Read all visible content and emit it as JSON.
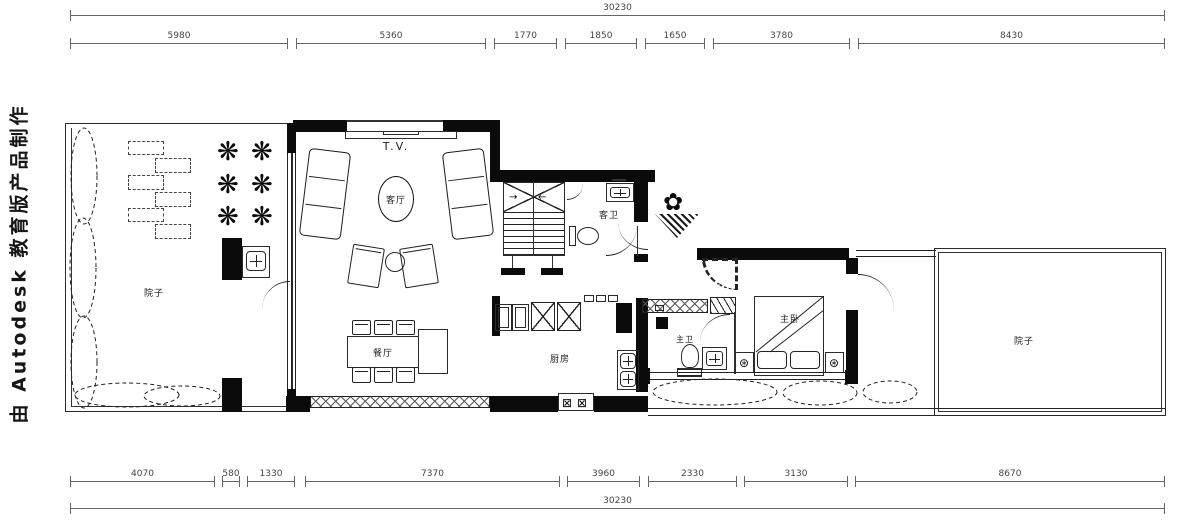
{
  "watermark": {
    "text": "由 Autodesk 教育版产品制作"
  },
  "icons": {
    "tree": "❋",
    "plant": "✿",
    "lamp": "⊛",
    "burner": "⊠",
    "arrow_left": "←",
    "arrow_right": "→"
  },
  "dims": {
    "top_total": "30230",
    "bottom_total": "30230",
    "top": [
      {
        "v": "5980"
      },
      {
        "v": "5360"
      },
      {
        "v": "1770"
      },
      {
        "v": "1850"
      },
      {
        "v": "1650"
      },
      {
        "v": "3780"
      },
      {
        "v": "8430"
      }
    ],
    "bottom": [
      {
        "v": "4070"
      },
      {
        "v": "580"
      },
      {
        "v": "1330"
      },
      {
        "v": "7370"
      },
      {
        "v": "3960"
      },
      {
        "v": "2330"
      },
      {
        "v": "3130"
      },
      {
        "v": "8670"
      }
    ]
  },
  "rooms": {
    "tv": "T.V.",
    "living": "客厅",
    "dining": "餐厅",
    "kitchen": "厨房",
    "guest_bath": "客卫",
    "master_bath": "主卫",
    "master_bed": "主卧",
    "yard_left": "院子",
    "yard_right": "院子"
  }
}
